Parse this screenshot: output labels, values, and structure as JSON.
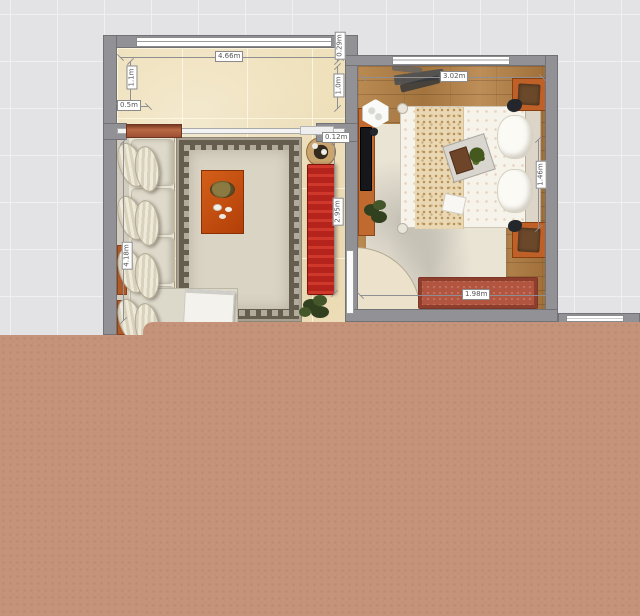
{
  "app": {
    "view": "2d-floorplan"
  },
  "dims": {
    "lr_top_width": "4.66m",
    "lr_left_upper": "1.1m",
    "lr_left_inset": "0.5m",
    "lr_right_wall": "0.29m",
    "lr_right_upper": "1.0m",
    "lr_sofa_length": "4.18m",
    "lr_cabinet_length": "2.95m",
    "lr_stool_gap": "0.12m",
    "br_top_width": "3.02m",
    "br_bed_width": "1.46m",
    "br_bench_width": "1.98m"
  },
  "colors": {
    "grid_bg": "#e3e3e6",
    "wall": "#929296",
    "living_floor": "#efe1bc",
    "bedroom_wood": "#b07f48",
    "rug_field": "#dad4c5",
    "cabinet_red": "#b5241c",
    "accent_orange": "#c06a30",
    "coffee_table": "#c24c10",
    "bench_red": "#b25540",
    "unrendered_tan": "#c49379"
  }
}
